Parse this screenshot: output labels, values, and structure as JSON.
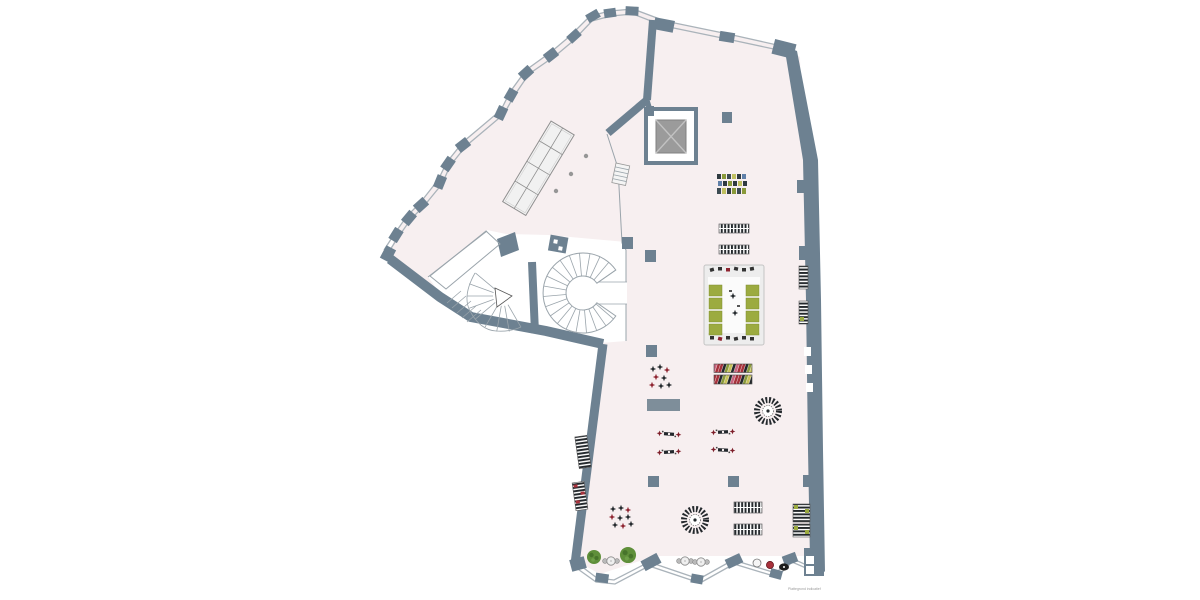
{
  "meta": {
    "type_label": "retail floor plan",
    "credit": "Plattegrond indicatief"
  },
  "colors": {
    "floor": "#f7eff0",
    "wall": "#6d8191",
    "wall_light": "#7e8e9a",
    "band": "#aab3ba",
    "line": "#9aa4ab",
    "shelf_fill": "#f1f1f1",
    "shelf_stroke": "#8f8f8f",
    "elevator_car": "#9b9b9b",
    "green": "#9cab40",
    "tree": "#5f8f3a",
    "red": "#a8323c",
    "dark_red": "#7e1f2a",
    "dark": "#23282c",
    "slate": "#3c4b52",
    "olive": "#8a9a3a",
    "yellow": "#c9c35a",
    "blue": "#6080a8",
    "pink": "#c8657f",
    "credit_gray": "#9b9b9b"
  }
}
